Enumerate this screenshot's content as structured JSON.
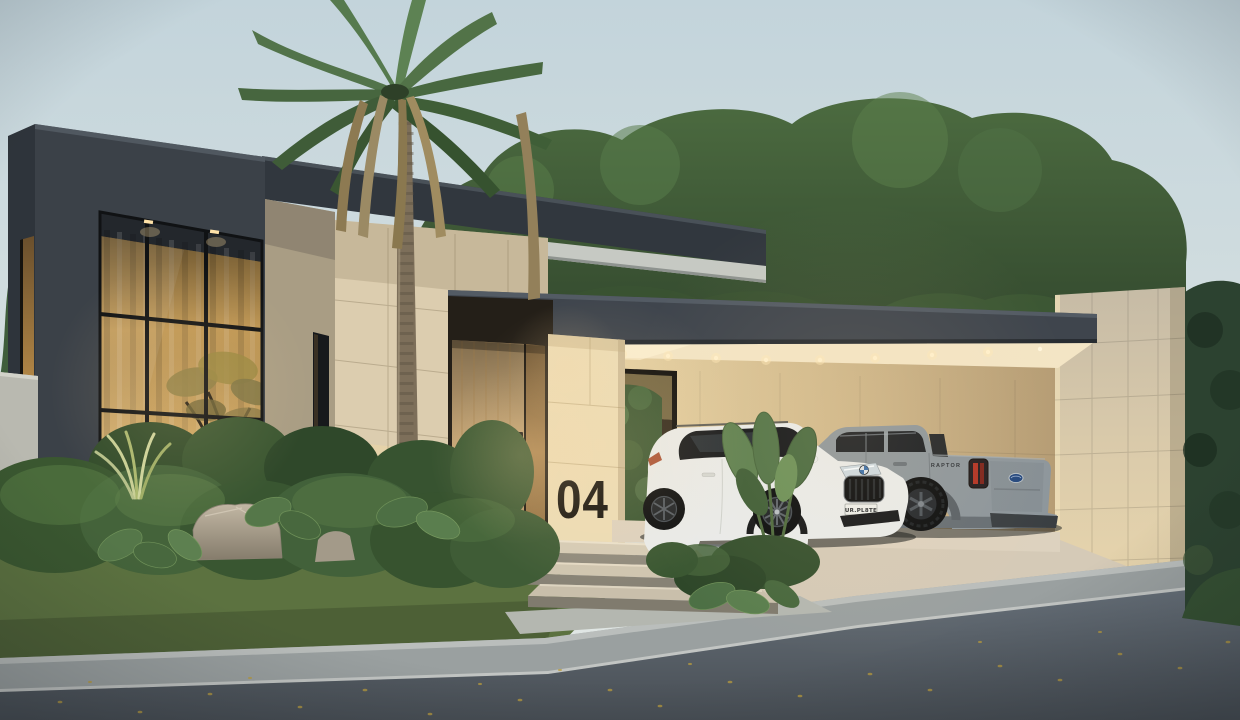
{
  "scene": {
    "house_number": "04",
    "vehicles": [
      {
        "name": "white-suv",
        "brand_mark": "bmw-roundel",
        "license_plate": "UR.PL8TE"
      },
      {
        "name": "gray-pickup",
        "brand_mark": "ford-oval",
        "badge": "RAPTOR"
      }
    ]
  },
  "palette": {
    "sky_top": "#c3d4db",
    "sky_horizon": "#e4e9e5",
    "charcoal": "#3f454d",
    "charcoal_dark": "#31373e",
    "travertine": "#dccdaf",
    "travertine_lit": "#ecdcb6",
    "soffit_cream": "#f3e5c5",
    "wood_door": "#c8a878",
    "curtain_gold": "#c89e58",
    "foliage": "#4c6b40",
    "foliage_dark": "#2c4230",
    "lawn": "#5c7240",
    "concrete_walk": "#9aa0a0",
    "driveway": "#d5cab7",
    "road": "#666f78",
    "suv_white": "#e9ebea",
    "truck_gray": "#8d969c",
    "glow_warm": "#ffd9a0",
    "number_black": "#17140f"
  }
}
